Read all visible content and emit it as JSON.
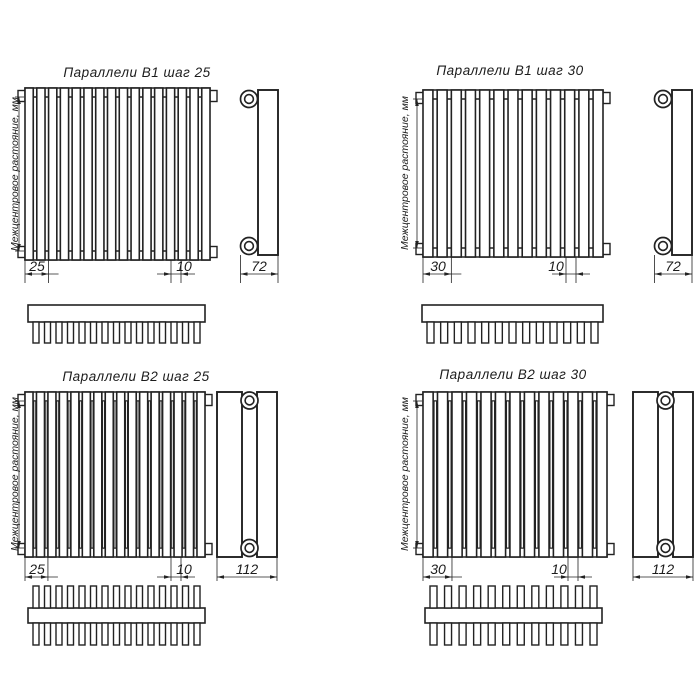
{
  "drawing": {
    "background": "#ffffff",
    "line_color": "#222222",
    "diagrams": [
      {
        "title": "Параллели В1 шаг 25",
        "axis_label": "Межцентровое растояние, мм",
        "step_dim": "25",
        "tube_dim": "10",
        "depth_dim": "72",
        "variant": "B1",
        "front_tubes": 16,
        "comb_teeth": 15,
        "comb_double_sided": false
      },
      {
        "title": "Параллели В1 шаг 30",
        "axis_label": "Межцентровое растояние, мм",
        "step_dim": "30",
        "tube_dim": "10",
        "depth_dim": "72",
        "variant": "B1",
        "front_tubes": 13,
        "comb_teeth": 13,
        "comb_double_sided": false
      },
      {
        "title": "Параллели В2 шаг 25",
        "axis_label": "Межцентровое растояние, мм",
        "step_dim": "25",
        "tube_dim": "10",
        "depth_dim": "112",
        "variant": "B2",
        "front_tubes": 16,
        "comb_teeth": 15,
        "comb_double_sided": true
      },
      {
        "title": "Параллели В2 шаг 30",
        "axis_label": "Межцентровое растояние, мм",
        "step_dim": "30",
        "tube_dim": "10",
        "depth_dim": "112",
        "variant": "B2",
        "front_tubes": 13,
        "comb_teeth": 12,
        "comb_double_sided": true
      }
    ]
  }
}
